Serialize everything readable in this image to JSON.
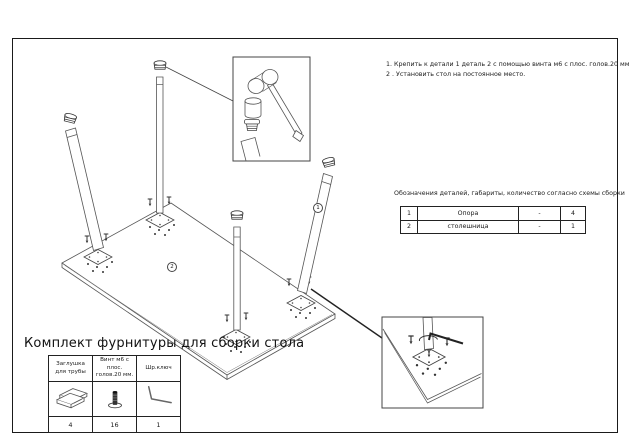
{
  "instructions": {
    "line1": "1. Крепить к детали 1 деталь 2 с помощью винта м6 с плос. голов.20 мм.",
    "line2": "2 . Установить стол на постоянное место."
  },
  "parts_note": "Обозначения деталей, габариты, количество согласно схемы сборки",
  "parts_table": {
    "rows": [
      {
        "num": "1",
        "name": "Опора",
        "dim": "-",
        "qty": "4"
      },
      {
        "num": "2",
        "name": "столешница",
        "dim": "-",
        "qty": "1"
      }
    ]
  },
  "hardware_kit": {
    "title": "Комплект фурнитуры для сборки стола",
    "columns": [
      {
        "label": "Заглушка для трубы",
        "icon": "pipe-plug-icon",
        "qty": "4"
      },
      {
        "label": "Винт м6 с плос. голов.20 мм.",
        "icon": "flat-head-screw-icon",
        "qty": "16"
      },
      {
        "label": "Шр.ключ",
        "icon": "hex-key-icon",
        "qty": "1"
      }
    ]
  },
  "diagram": {
    "callout_1_label": "1",
    "callout_2_label": "2"
  },
  "colors": {
    "frame": "#1a1a1a",
    "line": "#4a4a4a",
    "dark_line": "#222222"
  }
}
